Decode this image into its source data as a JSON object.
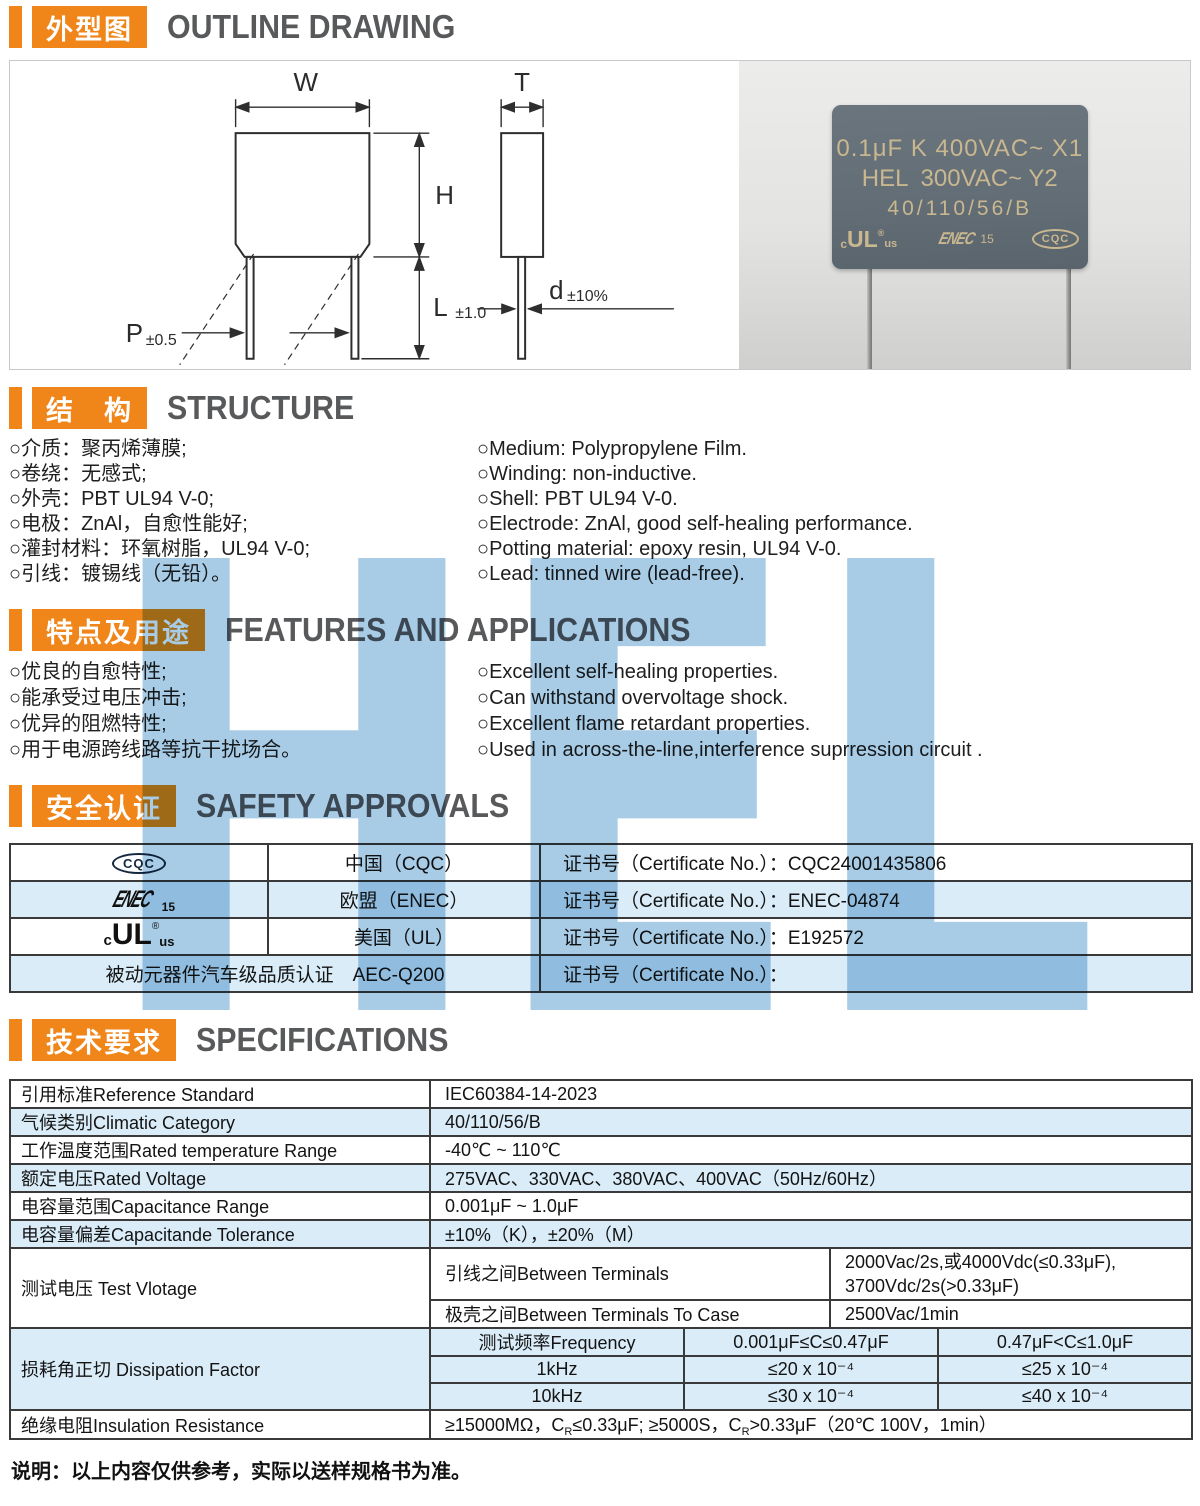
{
  "watermark": "HEL",
  "sections": {
    "outline": {
      "cn": "外型图",
      "en": "OUTLINE DRAWING"
    },
    "structure": {
      "cn": "结　构",
      "en": "STRUCTURE"
    },
    "features": {
      "cn": "特点及用途",
      "en": "FEATURES AND APPLICATIONS"
    },
    "safety": {
      "cn": "安全认证",
      "en": "SAFETY APPROVALS"
    },
    "specs": {
      "cn": "技术要求",
      "en": "SPECIFICATIONS"
    }
  },
  "drawing": {
    "w": "W",
    "t": "T",
    "h": "H",
    "l": "L",
    "l_tol": "±1.0",
    "d": "d",
    "d_tol": "±10%",
    "p": "P",
    "p_tol": "±0.5"
  },
  "photo": {
    "line1": "0.1μF K 400VAC~ X1",
    "brand": "HEL",
    "line2_right": "300VAC~ Y2",
    "line3": "40/110/56/B",
    "marks": {
      "ul_c": "c",
      "ul_main": "UL",
      "ul_reg": "®",
      "ul_us": "us",
      "enec_text": "ENEC",
      "enec_num": "15",
      "cqc_text": "CQC"
    }
  },
  "structure": {
    "cn": [
      "○介质：聚丙烯薄膜;",
      "○卷绕：无感式;",
      "○外壳：PBT UL94 V-0;",
      "○电极：ZnAl，自愈性能好;",
      "○灌封材料：环氧树脂，UL94 V-0;",
      "○引线：镀锡线（无铅）。"
    ],
    "en": [
      "○Medium: Polypropylene Film.",
      "○Winding: non-inductive.",
      "○Shell: PBT UL94 V-0.",
      "○Electrode: ZnAl, good self-healing performance.",
      "○Potting material: epoxy resin, UL94 V-0.",
      "○Lead: tinned wire (lead-free)."
    ]
  },
  "features": {
    "cn": [
      "○优良的自愈特性;",
      "○能承受过电压冲击;",
      "○优异的阻燃特性;",
      "○用于电源跨线路等抗干扰场合。"
    ],
    "en": [
      "○Excellent self-healing properties.",
      "○Can withstand overvoltage shock.",
      "○Excellent flame retardant properties.",
      "○Used in across-the-line,interference suprression circuit ."
    ]
  },
  "safety": {
    "logos": {
      "cqc": "CQC",
      "enec_text": "ENEC",
      "enec_num": "15",
      "ul_c": "c",
      "ul_main": "UL",
      "ul_reg": "®",
      "ul_us": "us"
    },
    "rows": [
      {
        "country": "中国（CQC）",
        "cert_label": "证书号（Certificate No.）：",
        "cert_no": "CQC24001435806"
      },
      {
        "country": "欧盟（ENEC）",
        "cert_label": "证书号（Certificate No.）：",
        "cert_no": "ENEC-04874"
      },
      {
        "country": "美国（UL）",
        "cert_label": "证书号（Certificate No.）：",
        "cert_no": "E192572"
      },
      {
        "label": "被动元器件汽车级品质认证　AEC-Q200",
        "cert_label": "证书号（Certificate No.）：",
        "cert_no": ""
      }
    ]
  },
  "specs": {
    "rows": [
      {
        "label": "引用标准Reference Standard",
        "value": "IEC60384-14-2023"
      },
      {
        "label": "气候类别Climatic Category",
        "value": "40/110/56/B"
      },
      {
        "label": "工作温度范围Rated temperature Range",
        "value": "-40℃ ~ 110℃"
      },
      {
        "label": "额定电压Rated Voltage",
        "value": "275VAC、330VAC、380VAC、400VAC（50Hz/60Hz）"
      },
      {
        "label": "电容量范围Capacitance Range",
        "value": "0.001μF ~ 1.0μF"
      },
      {
        "label": "电容量偏差Capacitande Tolerance",
        "value": "±10%（K），±20%（M）"
      }
    ],
    "test_voltage": {
      "label": "测试电压 Test Vlotage",
      "row1_label": "引线之间Between Terminals",
      "row1_value_line1": "2000Vac/2s,或4000Vdc(≤0.33μF),",
      "row1_value_line2": "3700Vdc/2s(>0.33μF)",
      "row2_label": "极壳之间Between Terminals To Case",
      "row2_value": "2500Vac/1min"
    },
    "dissipation": {
      "label": "损耗角正切 Dissipation Factor",
      "header": [
        "测试频率Frequency",
        "0.001μF≤C≤0.47μF",
        "0.47μF<C≤1.0μF"
      ],
      "rows": [
        [
          "1kHz",
          "≤20 x 10⁻⁴",
          "≤25 x 10⁻⁴"
        ],
        [
          "10kHz",
          "≤30 x 10⁻⁴",
          "≤40 x 10⁻⁴"
        ]
      ]
    },
    "insulation": {
      "label": "绝缘电阻Insulation Resistance",
      "p1": "≥15000MΩ，C",
      "sub1": "R",
      "p2": "≤0.33μF;  ≥5000S，C",
      "sub2": "R",
      "p3": ">0.33μF（20℃ 100V，1min）"
    }
  },
  "footer_note": "说明：以上内容仅供参考，实际以送样规格书为准。"
}
